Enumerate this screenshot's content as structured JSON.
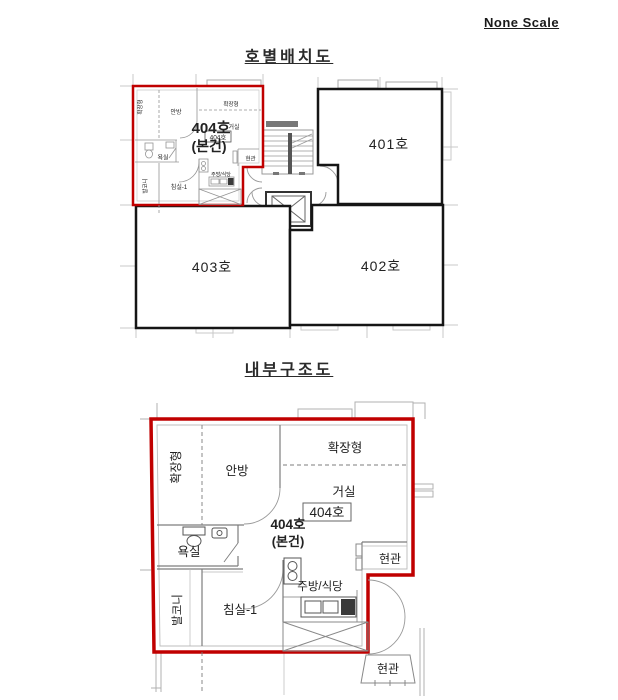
{
  "page": {
    "scale_note": "None Scale"
  },
  "colors": {
    "highlight": "#c00000",
    "highlight_text": "#cc1111",
    "wall": "#151515",
    "interior_line": "#7d7d7d",
    "faint_line": "#c9c9c9",
    "label_text": "#222222"
  },
  "unit_plan": {
    "title": "호별배치도",
    "subject_unit": {
      "label": "404호",
      "note": "(본건)"
    },
    "units": {
      "u401": "401호",
      "u402": "402호",
      "u403": "403호",
      "u404_box": "404호"
    },
    "rooms": {
      "extension_left": "확장형",
      "master_bedroom": "안방",
      "extension_top": "확장형",
      "living_room": "거실",
      "bathroom": "욕실",
      "entrance": "현관",
      "kitchen_dining": "주방/식당",
      "bedroom1": "침실-1",
      "balcony": "발코니"
    }
  },
  "interior_plan": {
    "title": "내부구조도",
    "unit_box_label": "404호",
    "subject_unit": {
      "label": "404호",
      "note": "(본건)"
    },
    "rooms": {
      "extension_left": "확장형",
      "master_bedroom": "안방",
      "extension_top": "확장형",
      "living_room": "거실",
      "bathroom": "욕실",
      "entrance": "현관",
      "kitchen_dining": "주방/식당",
      "bedroom1": "침실-1",
      "balcony": "발코니",
      "neighbor_entrance": "현관"
    }
  }
}
